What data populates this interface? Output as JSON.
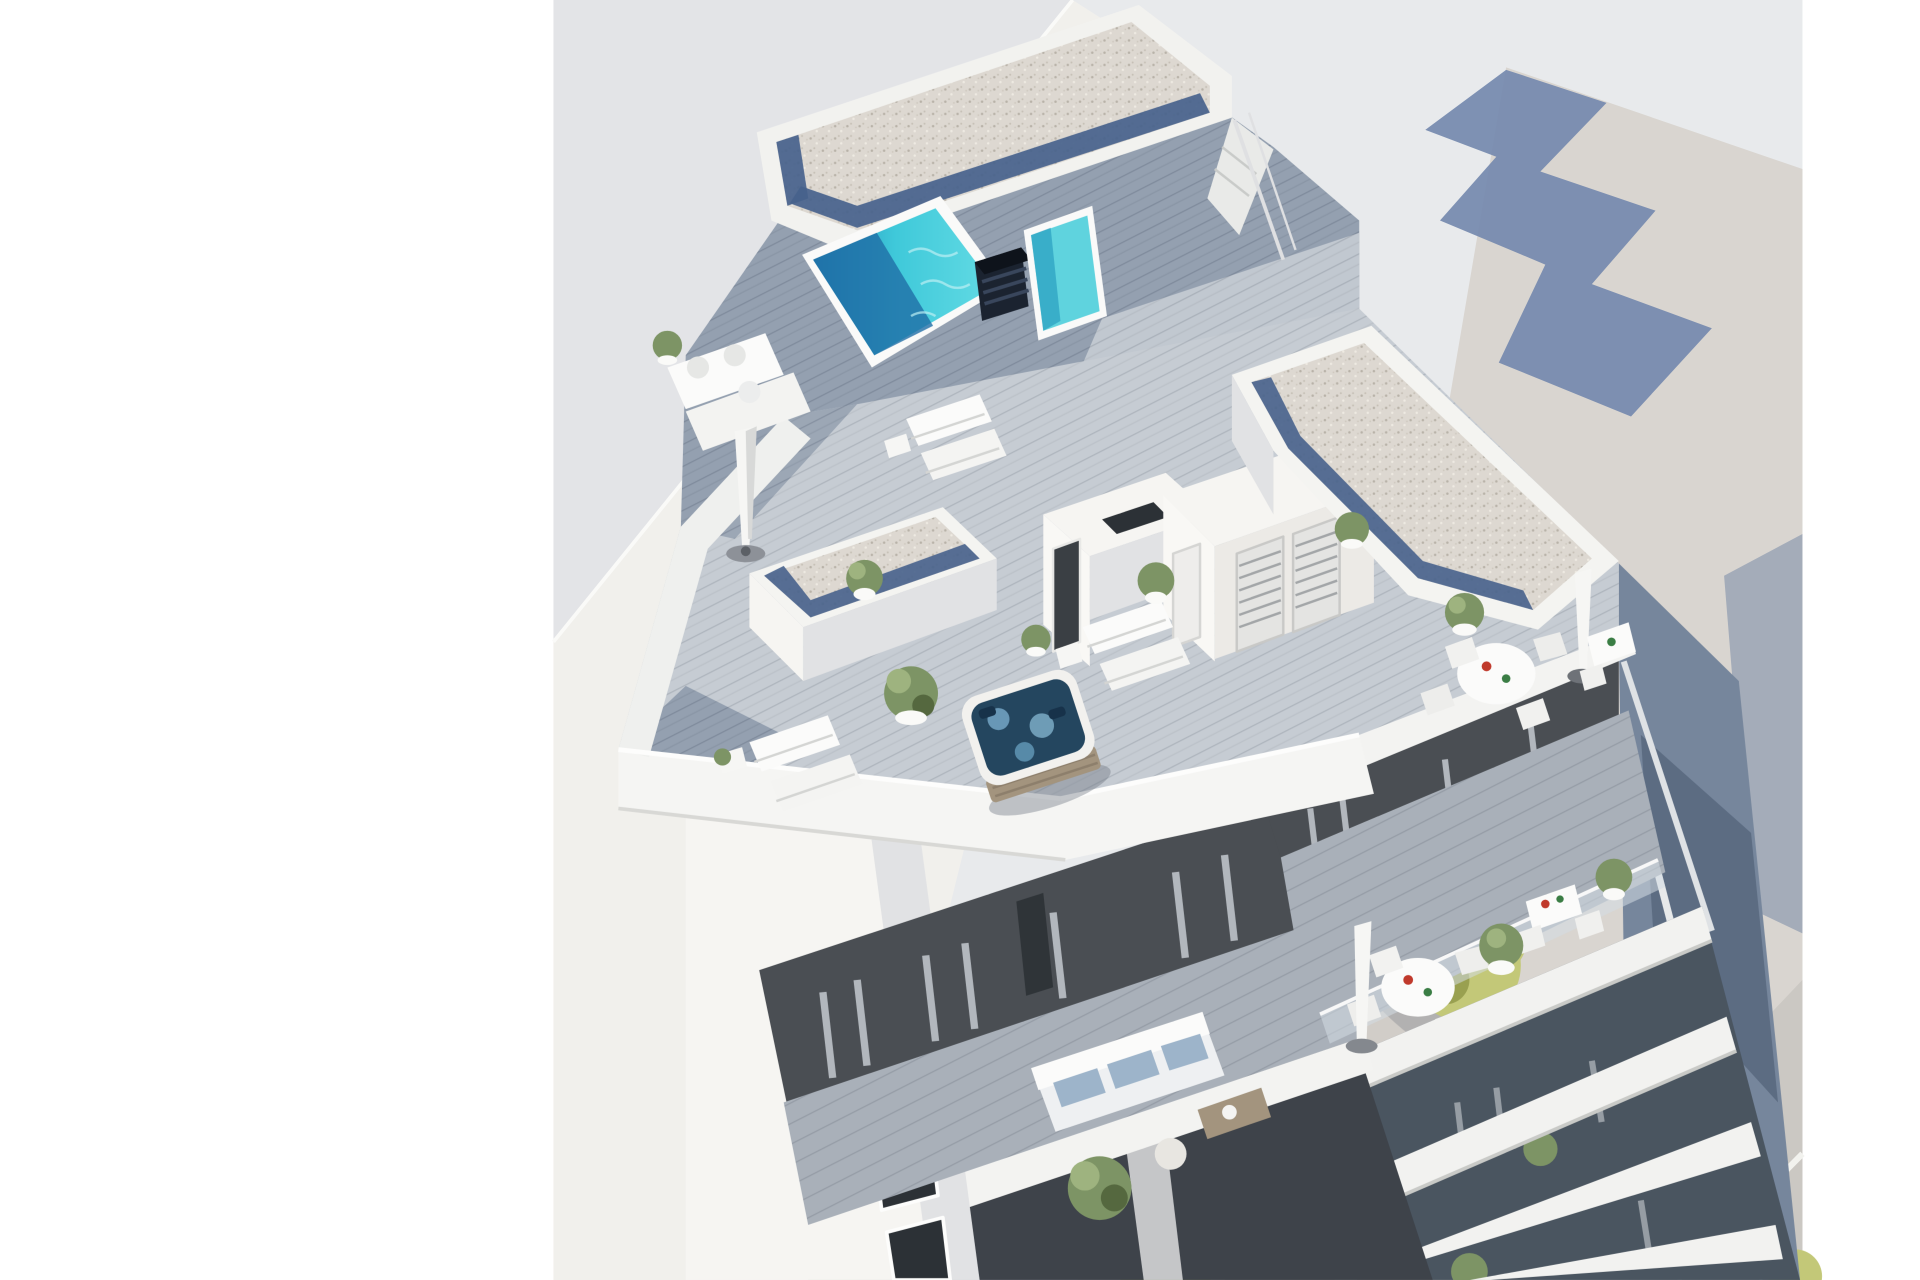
{
  "page": {
    "background": "#ffffff",
    "description": "Aerial 3D architectural rendering of a modern white apartment building with rooftop pool terraces, viewed from above against a plain studio background. No text appears in the image."
  },
  "colors": {
    "sky": "#e8eaec",
    "ground": "#d9d5d0",
    "building_shadow": "#7287ad",
    "neighbor_wall_shaded": "#e3e4e7",
    "neighbor_wall_lit": "#f1f0ec",
    "white_wall": "#f6f5f2",
    "white_wall_shade": "#e1e2e4",
    "deck_wood": "#c6ccd3",
    "deck_wood_shaded": "#94a0b0",
    "balcony_deck": "#a9b0b9",
    "gravel_roof": "#ddd8d1",
    "gravel_border_blue": "#47628c",
    "pool_water": "#3fc9da",
    "pool_water_deep": "#1f6ea6",
    "lap_pool_water": "#5fd3de",
    "jacuzzi_water": "#24465f",
    "anthracite_facade": "#4a4e53",
    "glass_dark": "#4a5560",
    "curtain": "#aab0b6",
    "plant_green": "#7d9465",
    "street_tree": "#c3c878",
    "road": "#cbc8c3",
    "road_marking": "#f2f2ee",
    "sofa_cushion_blue": "#9db4ca",
    "umbrella_white": "#f6f6f4",
    "wood_furniture": "#a3947e",
    "vent_chimney": "#1b2330",
    "dark_opening": "#2c3136",
    "side_wall_glass": "#76869c"
  },
  "scene": {
    "type": "3d-architectural-render",
    "subject": "Modern white residential building, bird's-eye view",
    "features": [
      "rooftop swimming pool (turquoise with deep blue shaded end)",
      "rooftop lap pool behind black louvered vent chimney",
      "hot tub jacuzzi with wood skirt on penthouse terrace",
      "white sun loungers and daybeds with cushions",
      "closed white patio umbrellas with round bases",
      "round white dining tables with chairs",
      "white bar tables with stools",
      "potted green plants and topiary",
      "gravel flat roofs edged with blue stone strips",
      "louvered white shutters and doors on penthouse volumes",
      "gray wood deck terraces",
      "glass balustrades",
      "anthracite glazed facade with light curtains",
      "balcony with white sofa and blue cushions, coffee table and pouf",
      "stacked white balcony slabs on lower floors",
      "street with sidewalk, trees, tree grates, edge line and dashed lane marking",
      "large neighboring building at left, building shadow cast on ground at right"
    ]
  }
}
